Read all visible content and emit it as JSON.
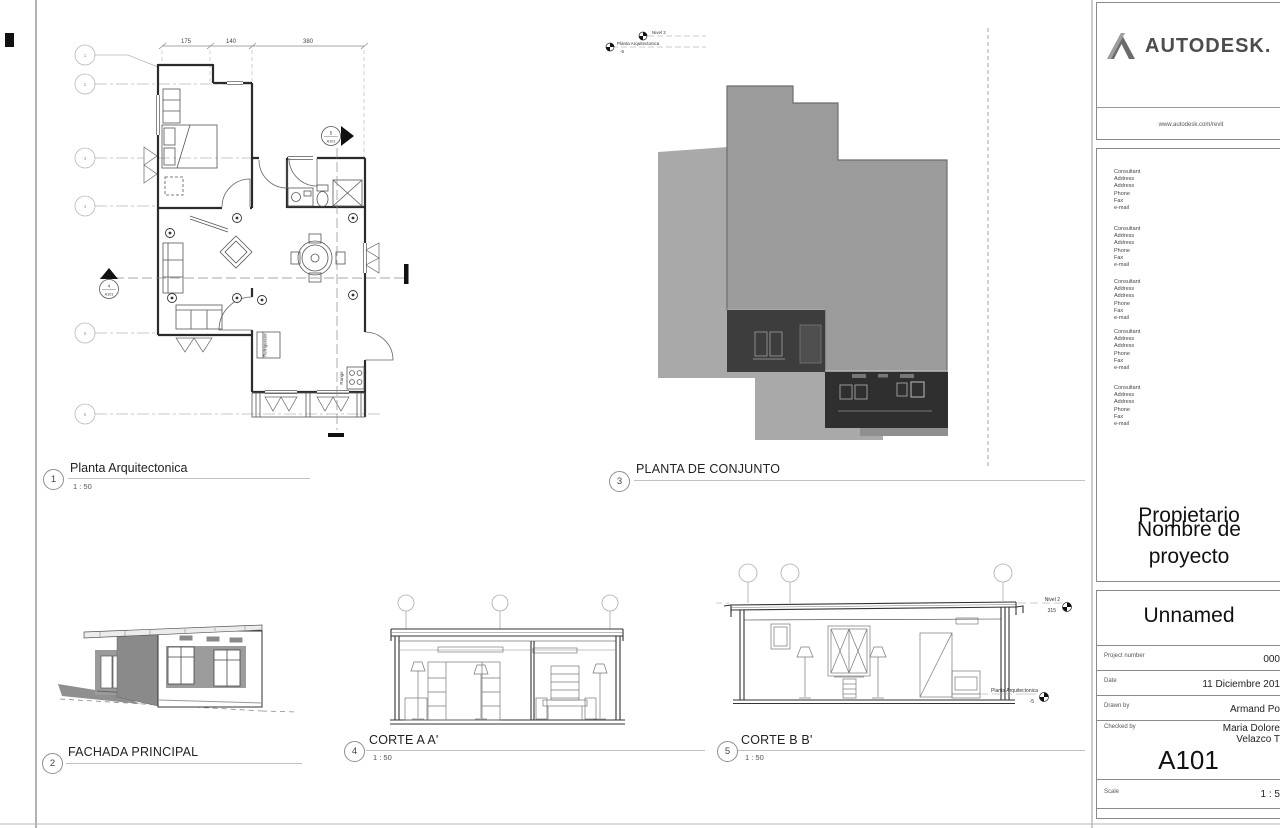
{
  "sheet": {
    "views": {
      "plan": {
        "num": "1",
        "title": "Planta Arquitectonica",
        "scale": "1 : 50"
      },
      "fachada": {
        "num": "2",
        "title": "FACHADA PRINCIPAL"
      },
      "conjunto": {
        "num": "3",
        "title": "PLANTA DE CONJUNTO"
      },
      "corte_a": {
        "num": "4",
        "title": "CORTE A A'",
        "scale": "1 : 50"
      },
      "corte_b": {
        "num": "5",
        "title": "CORTE B B'",
        "scale": "1 : 50"
      }
    },
    "plan_annotations": {
      "dim1": "175",
      "dim2": "140",
      "dim3": "380",
      "grid1": "1",
      "grid2": "2",
      "grid3": "3",
      "grid4": "4",
      "grid5": "5",
      "grid6": "6",
      "refrigerator": "Refrigerator",
      "range": "Range",
      "section5_num": "5",
      "section5_sheet": "A101",
      "section4_num": "4",
      "section4_sheet": "A101"
    },
    "site_annotations": {
      "nivel2": "Nivel 2",
      "planta": "Planta Arquitectonica",
      "planta_elev": "-5"
    },
    "corte_b_levels": {
      "nivel2": "Nivel 2",
      "nivel2_elev": "315",
      "planta": "Planta Arquitectonica",
      "planta_elev": "-5"
    },
    "colors": {
      "terrain_gray": "#a9a9a9",
      "roof_gray": "#9b9b9b",
      "dark_wall": "#3a3a3a",
      "logo_gray": "#4d4d4d"
    }
  },
  "titleblock": {
    "brand": "AUTODESK.",
    "url": "www.autodesk.com/revit",
    "consultant": {
      "l1": "Consultant",
      "l2": "Address",
      "l3": "Address",
      "l4": "Phone",
      "l5": "Fax",
      "l6": "e-mail"
    },
    "owner": "Propietario",
    "project_name": "Nombre de proyecto",
    "client": "Unnamed",
    "label_project_number": "Project number",
    "value_project_number": "000",
    "label_date": "Date",
    "value_date": "11 Diciembre 201",
    "label_drawn": "Drawn by",
    "value_drawn": "Armand Po",
    "label_checked": "Checked by",
    "value_checked_1": "Maria Dolore",
    "value_checked_2": "Velazco T",
    "sheet_number": "A101",
    "label_scale": "Scale",
    "value_scale": "1 : 5"
  }
}
